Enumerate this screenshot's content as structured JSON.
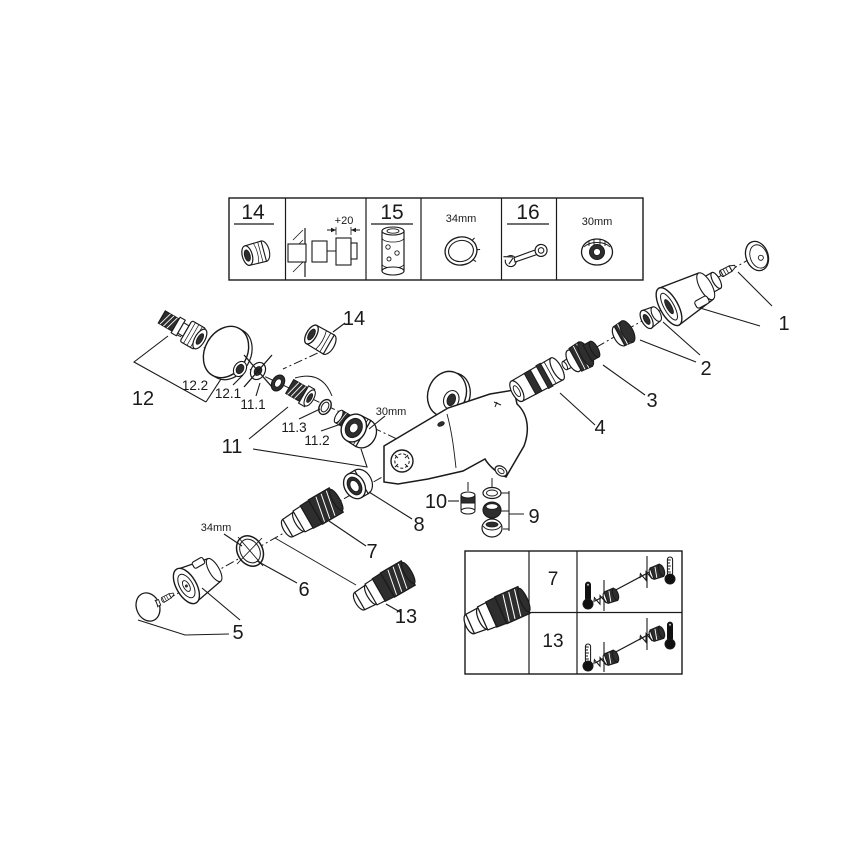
{
  "top_box": {
    "cell_14": {
      "number": "14",
      "icon": "cap-nut-icon"
    },
    "cell_extension": {
      "dimension": "+20",
      "icon": "wall-extension-icon"
    },
    "cell_15": {
      "number": "15",
      "icon": "extension-sleeve-icon"
    },
    "cell_ring": {
      "dimension": "34mm",
      "icon": "ring-nut-icon"
    },
    "cell_16": {
      "number": "16",
      "icon": "wrench-icon"
    },
    "cell_nut": {
      "dimension": "30mm",
      "icon": "union-nut-icon"
    }
  },
  "callouts": {
    "p1": "1",
    "p2": "2",
    "p3": "3",
    "p4": "4",
    "p5": "5",
    "p6": "6",
    "p7": "7",
    "p8": "8",
    "p9": "9",
    "p10": "10",
    "p11": "11",
    "p11_1": "11.1",
    "p11_2": "11.2",
    "p11_3": "11.3",
    "p12": "12",
    "p12_1": "12.1",
    "p12_2": "12.2",
    "p13": "13",
    "p14": "14"
  },
  "dims": {
    "nut_30mm": "30mm",
    "ring_34mm": "34mm"
  },
  "bottom_box": {
    "row7": "7",
    "row13": "13"
  }
}
